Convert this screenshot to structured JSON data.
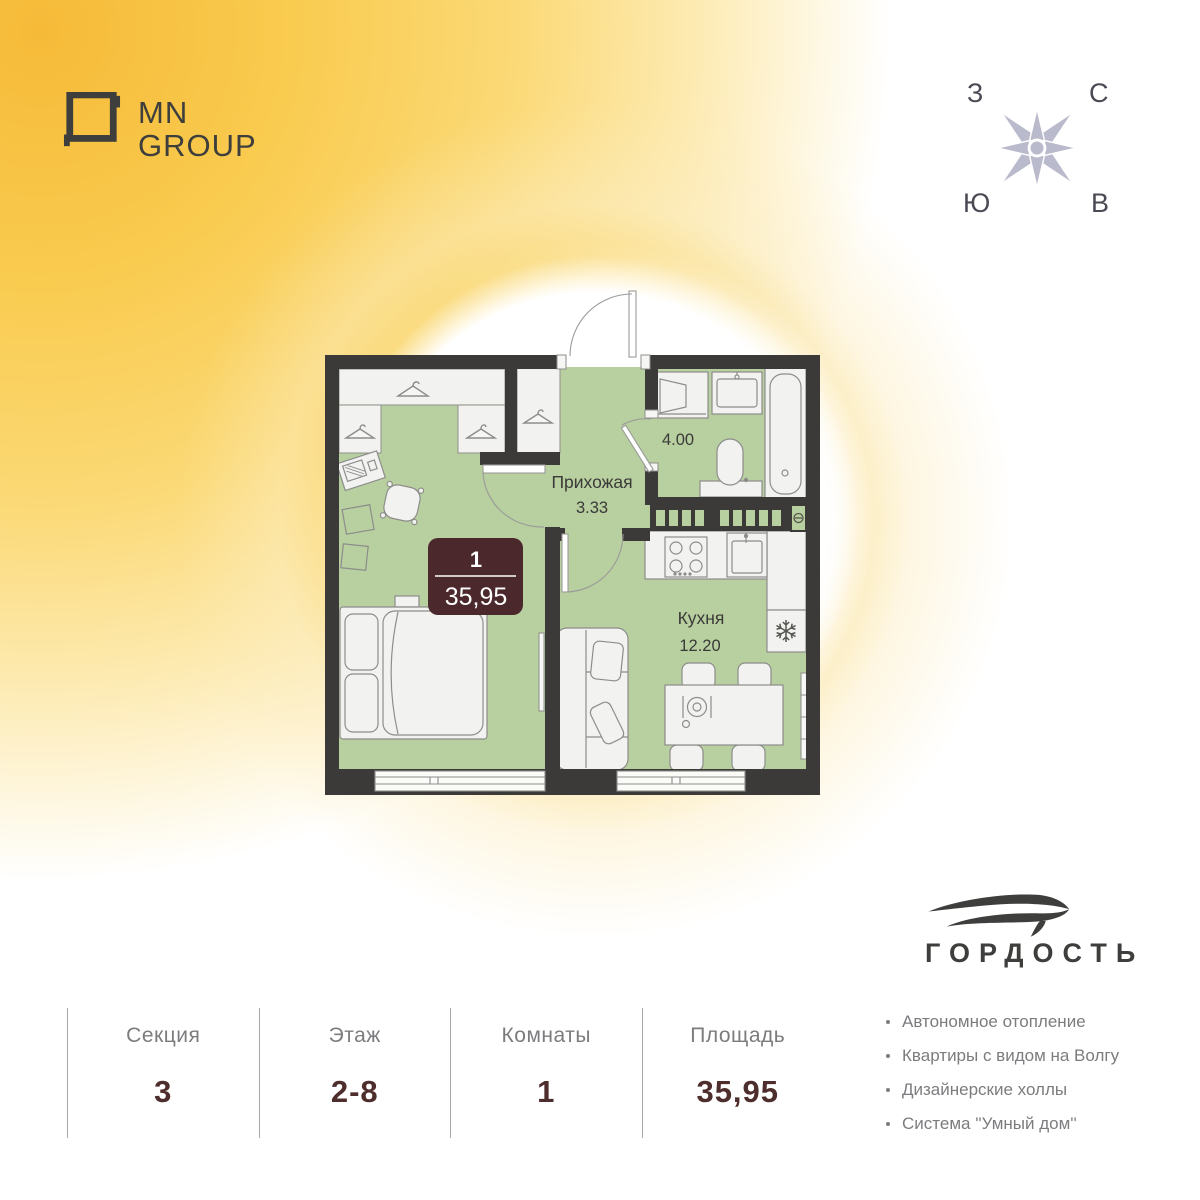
{
  "header": {
    "logo": {
      "line1": "MN",
      "line2": "GROUP"
    }
  },
  "compass": {
    "west": "З",
    "north": "С",
    "south": "Ю",
    "east": "В"
  },
  "floor_plan": {
    "unit_badge": {
      "rooms": "1",
      "area": "35,95"
    },
    "rooms": {
      "hallway": {
        "name": "Прихожая",
        "area": "3.33"
      },
      "bathroom": {
        "area": "4.00"
      },
      "kitchen": {
        "name": "Кухня",
        "area": "12.20"
      }
    }
  },
  "developer": {
    "name": "ГОРДОСТЬ"
  },
  "features": {
    "items": [
      {
        "text": "Автономное отопление"
      },
      {
        "text": "Квартиры с видом на Волгу"
      },
      {
        "text": "Дизайнерские холлы"
      },
      {
        "text": "Система ''Умный дом''"
      }
    ]
  },
  "summary": {
    "columns": [
      {
        "label": "Секция",
        "value": "3"
      },
      {
        "label": "Этаж",
        "value": "2-8"
      },
      {
        "label": "Комнаты",
        "value": "1"
      },
      {
        "label": "Площадь",
        "value": "35,95"
      }
    ]
  },
  "colors": {
    "accent_yellow": "#f8c649",
    "wall": "#3b3a38",
    "floor_green": "#b8cfa0",
    "badge_brown": "#4b282b",
    "value_brown": "#4e2d2d",
    "text_gray": "#7c7c7f",
    "logo_dark": "#3e3e3c",
    "compass_lavender": "#babacd"
  }
}
